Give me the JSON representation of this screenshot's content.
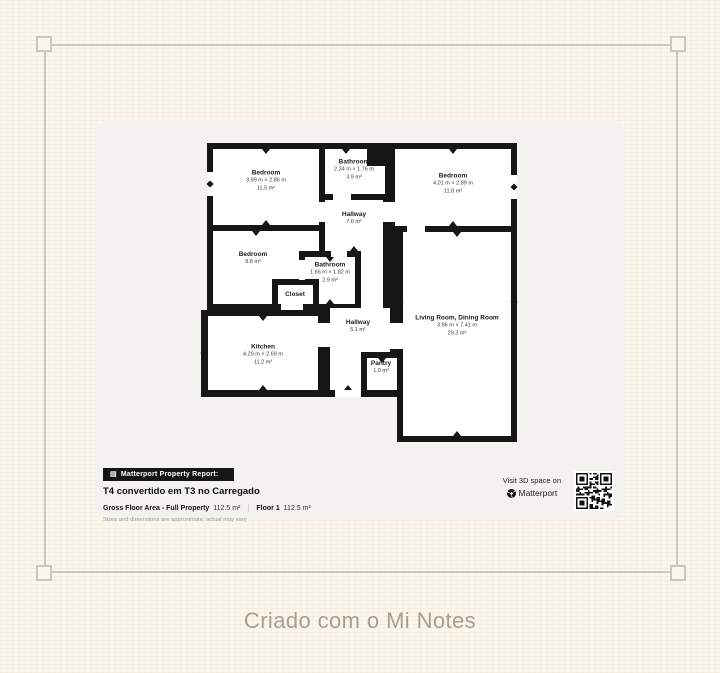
{
  "page": {
    "caption": "Criado com o Mi Notes"
  },
  "floorplan": {
    "rooms": [
      {
        "id": "bedroom-top-left",
        "name": "Bedroom",
        "dims": "3.99 m × 2.86 m",
        "area": "11.5 m²"
      },
      {
        "id": "bathroom-top",
        "name": "Bathroom",
        "dims": "2.34 m × 1.76 m",
        "area": "3.9 m²"
      },
      {
        "id": "bedroom-top-right",
        "name": "Bedroom",
        "dims": "4.01 m × 2.89 m",
        "area": "11.8 m²"
      },
      {
        "id": "hallway-upper",
        "name": "Hallway",
        "area": "7.0 m²"
      },
      {
        "id": "bedroom-middle",
        "name": "Bedroom",
        "area": "8.8 m²"
      },
      {
        "id": "bathroom-middle",
        "name": "Bathroom",
        "dims": "1.66 m × 1.82 m",
        "area": "2.9 m²"
      },
      {
        "id": "closet",
        "name": "Closet"
      },
      {
        "id": "kitchen",
        "name": "Kitchen",
        "dims": "4.29 m × 2.69 m",
        "area": "11.2 m²"
      },
      {
        "id": "hallway-lower",
        "name": "Hallway",
        "area": "5.1 m²"
      },
      {
        "id": "pantry",
        "name": "Pantry",
        "area": "1.0 m²"
      },
      {
        "id": "living-dining",
        "name": "Living Room, Dining Room",
        "dims": "3.96 m × 7.41 m",
        "area": "29.3 m²"
      }
    ]
  },
  "report": {
    "badge_label": "Matterport Property Report:",
    "title": "T4 convertido em T3 no Carregado",
    "gross_area_label": "Gross Floor Area - Full Property",
    "gross_area_value": "112.5 m²",
    "divider": "|",
    "floor_label": "Floor 1",
    "floor_value": "112.5 m²",
    "disclaimer": "Sizes and dimensions are approximate, actual may vary",
    "visit_label": "Visit 3D space on",
    "brand_name": "Matterport"
  },
  "icons": {
    "report_icon": "matterport-report-icon",
    "logo_icon": "matterport-logo-icon",
    "qr": "qr-code"
  },
  "colors": {
    "page_bg": "#fbf7ee",
    "frame_line": "#ccc6bb",
    "card_bg": "#f3f2ef",
    "wall": "#161616",
    "caption_text": "#a89f8f",
    "badge_bg": "#161616"
  }
}
